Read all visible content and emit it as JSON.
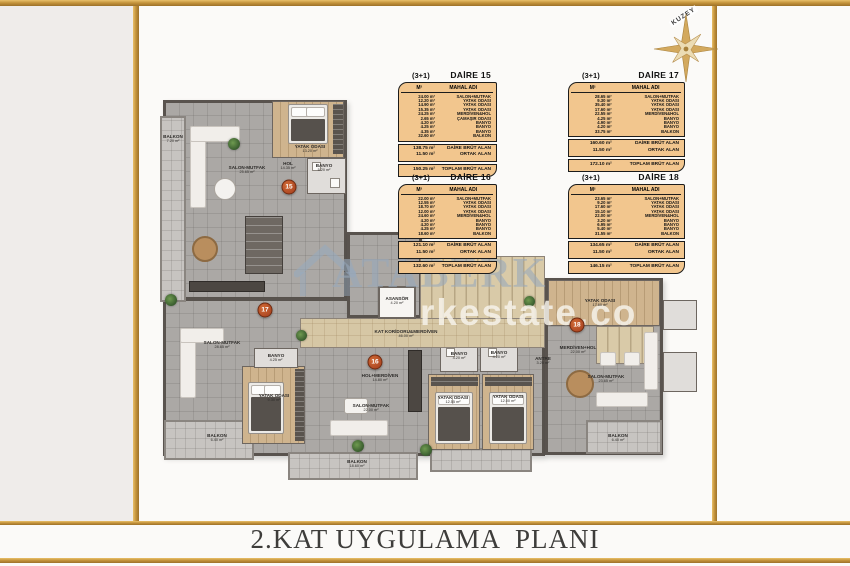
{
  "page": {
    "title": "2.KAT UYGULAMA  PLANI"
  },
  "compass": {
    "label": "KUZEY"
  },
  "watermark": {
    "brand": "ATABERK",
    "domain": "rkestate.co"
  },
  "colors": {
    "gold_frame": "#c2913a",
    "table_bg": "#f2c68e",
    "badge": "#b04a24",
    "corridor": "#d6c7a5"
  },
  "col_headers": {
    "area": "M²",
    "name": "MAHAL ADI"
  },
  "apartments": [
    {
      "type": "(3+1)",
      "name": "DAİRE 15",
      "rows": [
        {
          "a": "24.00 m²",
          "n": "SALON+MUTFAK"
        },
        {
          "a": "12.20 m²",
          "n": "YATAK ODASI"
        },
        {
          "a": "14.90 m²",
          "n": "YATAK ODASI"
        },
        {
          "a": "15.35 m²",
          "n": "YATAK ODASI"
        },
        {
          "a": "24.25 m²",
          "n": "MERDİVEN&HOL"
        },
        {
          "a": "2.65 m²",
          "n": "ÇAMAŞIR ODASI"
        },
        {
          "a": "4.20 m²",
          "n": "BANYO"
        },
        {
          "a": "4.25 m²",
          "n": "BANYO"
        },
        {
          "a": "4.35 m²",
          "n": "BANYO"
        },
        {
          "a": "32.60 m²",
          "n": "BALKON"
        }
      ],
      "brut": {
        "a": "138.75 m²",
        "n": "DAİRE BRÜT ALAN"
      },
      "ortak": {
        "a": "11.50 m²",
        "n": "ORTAK ALAN"
      },
      "toplam": {
        "a": "150.25 m²",
        "n": "TOPLAM BRÜT ALAN"
      }
    },
    {
      "type": "(3+1)",
      "name": "DAİRE 16",
      "rows": [
        {
          "a": "22.00 m²",
          "n": "SALON+MUTFAK"
        },
        {
          "a": "12.55 m²",
          "n": "YATAK ODASI"
        },
        {
          "a": "18.70 m²",
          "n": "YATAK ODASI"
        },
        {
          "a": "12.00 m²",
          "n": "YATAK ODASI"
        },
        {
          "a": "24.60 m²",
          "n": "MERDİVEN&HOL"
        },
        {
          "a": "4.20 m²",
          "n": "BANYO"
        },
        {
          "a": "4.20 m²",
          "n": "BANYO"
        },
        {
          "a": "4.25 m²",
          "n": "BANYO"
        },
        {
          "a": "18.60 m²",
          "n": "BALKON"
        }
      ],
      "brut": {
        "a": "121.10 m²",
        "n": "DAİRE BRÜT ALAN"
      },
      "ortak": {
        "a": "11.50 m²",
        "n": "ORTAK ALAN"
      },
      "toplam": {
        "a": "132.60 m²",
        "n": "TOPLAM BRÜT ALAN"
      }
    },
    {
      "type": "(3+1)",
      "name": "DAİRE 17",
      "rows": [
        {
          "a": "28.65 m²",
          "n": "SALON+MUTFAK"
        },
        {
          "a": "9.30 m²",
          "n": "YATAK ODASI"
        },
        {
          "a": "35.40 m²",
          "n": "YATAK ODASI"
        },
        {
          "a": "17.60 m²",
          "n": "YATAK ODASI"
        },
        {
          "a": "22.55 m²",
          "n": "MERDİVEN&HOL"
        },
        {
          "a": "4.25 m²",
          "n": "BANYO"
        },
        {
          "a": "4.90 m²",
          "n": "BANYO"
        },
        {
          "a": "4.20 m²",
          "n": "BANYO"
        },
        {
          "a": "33.75 m²",
          "n": "BALKON"
        }
      ],
      "brut": {
        "a": "160.60 m²",
        "n": "DAİRE BRÜT ALAN"
      },
      "ortak": {
        "a": "11.50 m²",
        "n": "ORTAK ALAN"
      },
      "toplam": {
        "a": "172.10 m²",
        "n": "TOPLAM BRÜT ALAN"
      }
    },
    {
      "type": "(3+1)",
      "name": "DAİRE 18",
      "rows": [
        {
          "a": "23.65 m²",
          "n": "SALON+MUTFAK"
        },
        {
          "a": "9.20 m²",
          "n": "YATAK ODASI"
        },
        {
          "a": "17.60 m²",
          "n": "YATAK ODASI"
        },
        {
          "a": "15.10 m²",
          "n": "YATAK ODASI"
        },
        {
          "a": "22.00 m²",
          "n": "MERDİVEN&HOL"
        },
        {
          "a": "3.20 m²",
          "n": "BANYO"
        },
        {
          "a": "6.95 m²",
          "n": "BANYO"
        },
        {
          "a": "5.40 m²",
          "n": "BANYO"
        },
        {
          "a": "31.55 m²",
          "n": "BALKON"
        }
      ],
      "brut": {
        "a": "134.65 m²",
        "n": "DAİRE BRÜT ALAN"
      },
      "ortak": {
        "a": "11.50 m²",
        "n": "ORTAK ALAN"
      },
      "toplam": {
        "a": "146.15 m²",
        "n": "TOPLAM BRÜT ALAN"
      }
    }
  ],
  "plan": {
    "circles": {
      "c15": "15",
      "c16": "16",
      "c17": "17",
      "c18": "18"
    },
    "labels": {
      "balkon15": {
        "t": "BALKON",
        "s": "7.20 m²"
      },
      "salon15": {
        "t": "SALON-MUTFAK",
        "s": "25.65 m²"
      },
      "yatak15": {
        "t": "YATAK ODASI",
        "s": "13.20 m²"
      },
      "hol15": {
        "t": "HOL",
        "s": "14.35 m²"
      },
      "banyo15": {
        "t": "BANYO",
        "s": "5.20 m²"
      },
      "salon17": {
        "t": "SALON-MUTFAK",
        "s": "28.65 m²"
      },
      "banyo17": {
        "t": "BANYO",
        "s": "4.25 m²"
      },
      "yatak17": {
        "t": "YATAK ODASI",
        "s": "9.30 m²"
      },
      "balkon17": {
        "t": "BALKON",
        "s": "6.40 m²"
      },
      "asansor": {
        "t": "ASANSÖR",
        "s": "4.20 m²"
      },
      "koridor": {
        "t": "KAT KORİDORU&MERDİVEN",
        "s": "46.00 m²"
      },
      "hol16": {
        "t": "HOL+MERDİVEN",
        "s": "14.80 m²"
      },
      "banyo16a": {
        "t": "BANYO",
        "s": "4.20 m²"
      },
      "banyo16b": {
        "t": "BANYO",
        "s": "4.20 m²"
      },
      "yatak16a": {
        "t": "YATAK ODASI",
        "s": "12.55 m²"
      },
      "yatak16b": {
        "t": "YATAK ODASI",
        "s": "12.00 m²"
      },
      "salon16": {
        "t": "SALON-MUTFAK",
        "s": "22.00 m²"
      },
      "balkon16": {
        "t": "BALKON",
        "s": "18.60 m²"
      },
      "antre18": {
        "t": "ANTRE",
        "s": "3.20 m²"
      },
      "hol18": {
        "t": "MERDİVEN+HOL",
        "s": "22.00 m²"
      },
      "salon18": {
        "t": "SALON-MUTFAK",
        "s": "23.65 m²"
      },
      "balkon18": {
        "t": "BALKON",
        "s": "6.40 m²"
      },
      "yatak18": {
        "t": "YATAK ODASI",
        "s": "17.60 m²"
      }
    }
  }
}
